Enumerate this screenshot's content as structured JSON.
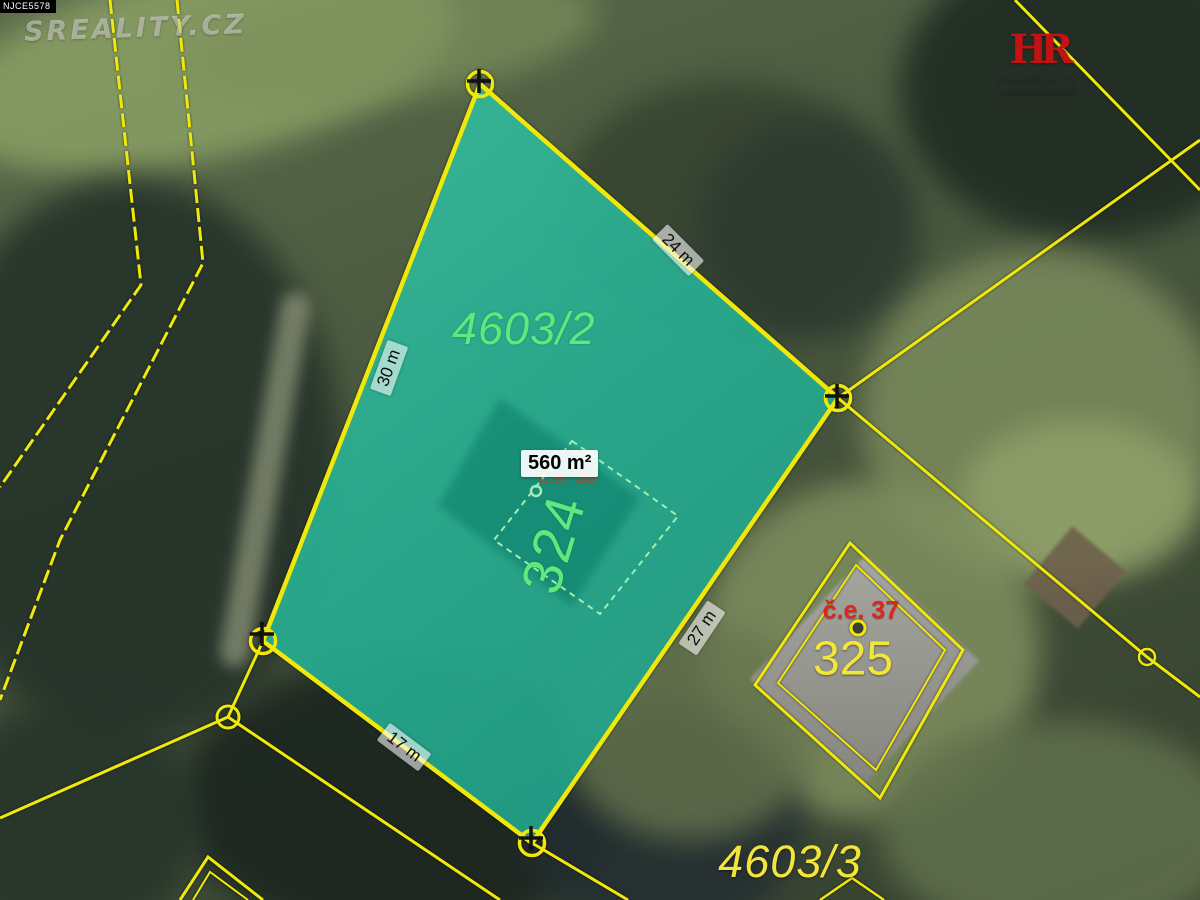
{
  "overlay": {
    "photo_id": "NJCE5578",
    "watermark": "SREALITY.CZ",
    "brand": {
      "monogram": "HR",
      "name": "HaviReality"
    }
  },
  "map": {
    "main_parcel": {
      "number": "4603/2",
      "area": "560 m²",
      "house_ref": "č.e. 36",
      "house_number": "324",
      "edge_lengths": {
        "top_right": "24 m",
        "left": "30 m",
        "bottom_right": "27 m",
        "bottom_left": "17 m"
      }
    },
    "neighbor_parcel": {
      "house_number": "325",
      "house_ref": "č.e. 37"
    },
    "adjacent_parcel": {
      "number": "4603/3"
    },
    "colors": {
      "boundary_yellow": "#f0e80a",
      "parcel_fill_teal": "#2cc3a4",
      "parcel_number_green": "#5fe87d",
      "house_ref_red": "#dd2012",
      "neighbor_label_yellow": "#f2e63c"
    }
  }
}
